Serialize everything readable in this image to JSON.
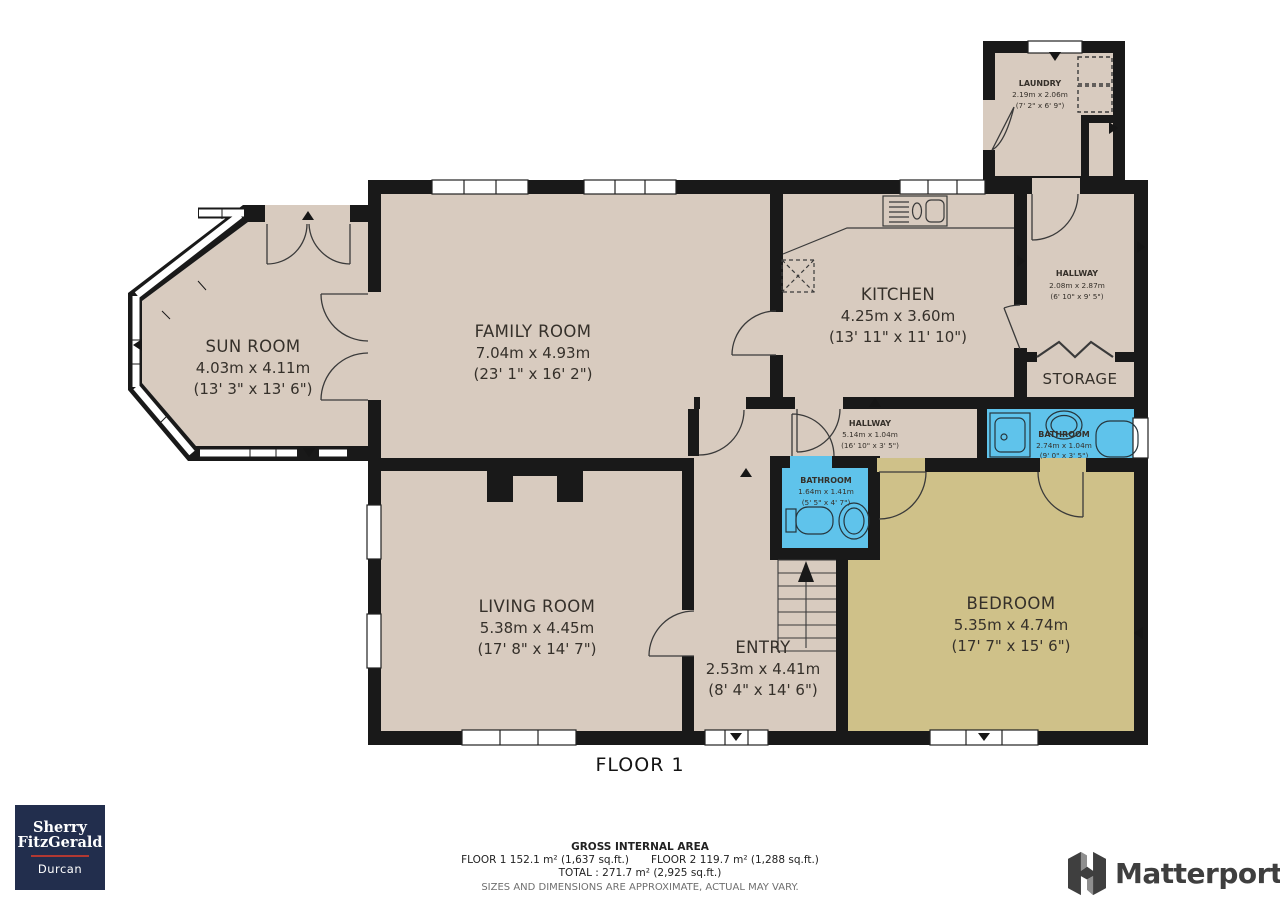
{
  "floor_label": "FLOOR 1",
  "rooms": {
    "sun_room": {
      "name": "SUN ROOM",
      "metric": "4.03m x 4.11m",
      "imperial": "(13' 3\" x 13' 6\")"
    },
    "family_room": {
      "name": "FAMILY ROOM",
      "metric": "7.04m x 4.93m",
      "imperial": "(23' 1\" x 16' 2\")"
    },
    "kitchen": {
      "name": "KITCHEN",
      "metric": "4.25m x 3.60m",
      "imperial": "(13' 11\" x 11' 10\")"
    },
    "laundry": {
      "name": "LAUNDRY",
      "metric": "2.19m x 2.06m",
      "imperial": "(7' 2\" x 6' 9\")"
    },
    "hallway_upper": {
      "name": "HALLWAY",
      "metric": "2.08m x 2.87m",
      "imperial": "(6' 10\" x 9' 5\")"
    },
    "storage": {
      "name": "STORAGE"
    },
    "bathroom_main": {
      "name": "BATHROOM",
      "metric": "2.74m x 1.04m",
      "imperial": "(9' 0\" x 3' 5\")"
    },
    "hallway_mid": {
      "name": "HALLWAY",
      "metric": "5.14m x 1.04m",
      "imperial": "(16' 10\" x 3' 5\")"
    },
    "bathroom_small": {
      "name": "BATHROOM",
      "metric": "1.64m x 1.41m",
      "imperial": "(5' 5\" x 4' 7\")"
    },
    "living_room": {
      "name": "LIVING ROOM",
      "metric": "5.38m x 4.45m",
      "imperial": "(17' 8\" x 14' 7\")"
    },
    "entry": {
      "name": "ENTRY",
      "metric": "2.53m x 4.41m",
      "imperial": "(8' 4\" x 14' 6\")"
    },
    "bedroom": {
      "name": "BEDROOM",
      "metric": "5.35m x 4.74m",
      "imperial": "(17' 7\" x 15' 6\")"
    }
  },
  "footer": {
    "title": "GROSS INTERNAL AREA",
    "floor1": "FLOOR 1 152.1 m² (1,637 sq.ft.)",
    "floor2": "FLOOR 2 119.7 m² (1,288 sq.ft.)",
    "total": "TOTAL :  271.7 m² (2,925 sq.ft.)",
    "disclaimer": "SIZES AND DIMENSIONS ARE APPROXIMATE, ACTUAL MAY VARY."
  },
  "branding": {
    "agency_line1": "Sherry",
    "agency_line2": "FitzGerald",
    "agency_line3": "Durcan",
    "matterport": "Matterport"
  },
  "colors": {
    "floor_beige": "#d8cbbf",
    "bedroom_tan": "#cfc189",
    "bathroom_blue": "#5fc3eb",
    "wall_black": "#191919",
    "agency_navy": "#222e4d",
    "agency_red": "#b23832",
    "matterport_gray": "#3f3f3f"
  }
}
